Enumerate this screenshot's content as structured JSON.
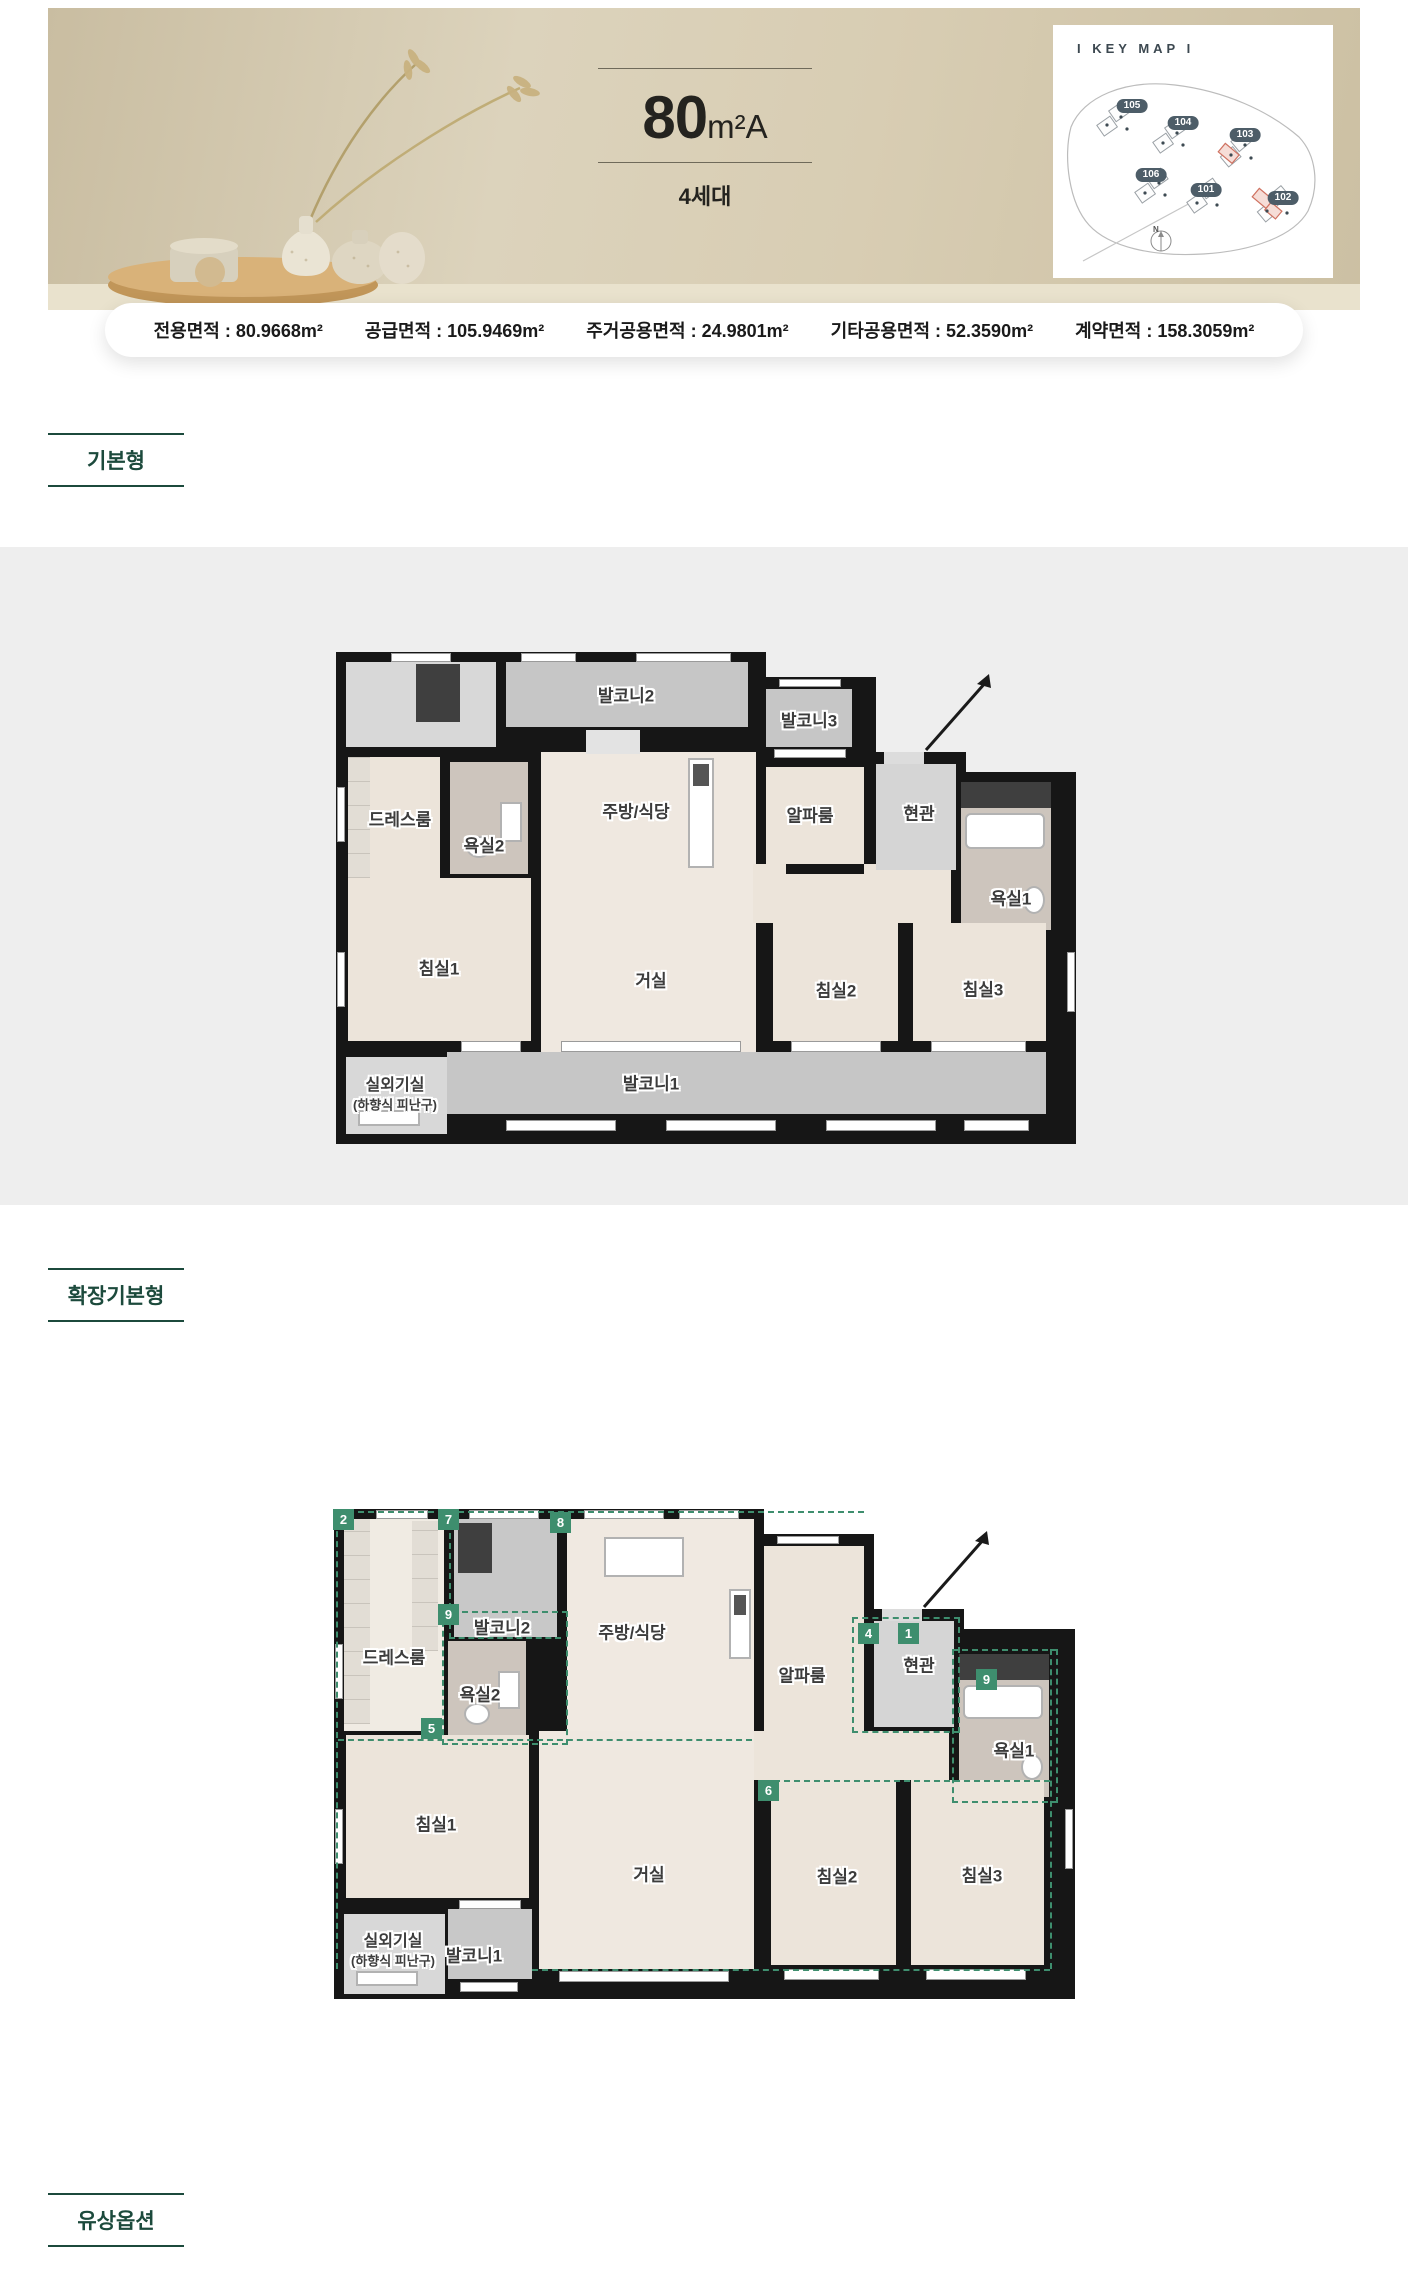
{
  "header": {
    "title_number": "80",
    "title_unit": "m²A",
    "subtitle": "4세대",
    "keymap": {
      "title": "I KEY MAP I",
      "compass": "N",
      "buildings": [
        "105",
        "104",
        "103",
        "106",
        "101",
        "102"
      ]
    },
    "area_items": [
      "전용면적 : 80.9668m²",
      "공급면적 : 105.9469m²",
      "주거공용면적 : 24.9801m²",
      "기타공용면적 : 52.3590m²",
      "계약면적 : 158.3059m²"
    ]
  },
  "sections": {
    "basic": "기본형",
    "extended": "확장기본형",
    "paid_option": "유상옵션"
  },
  "rooms": {
    "balcony2": "발코니2",
    "balcony3": "발코니3",
    "dressroom": "드레스룸",
    "bath2": "욕실2",
    "kitchen": "주방/식당",
    "alpha": "알파룸",
    "entry": "현관",
    "bath1": "욕실1",
    "bed1": "침실1",
    "living": "거실",
    "bed2": "침실2",
    "bed3": "침실3",
    "balcony1": "발코니1",
    "outdoor_unit": "실외기실",
    "outdoor_unit_sub": "(하향식 피난구)"
  },
  "extended_badges": [
    "2",
    "7",
    "8",
    "9",
    "5",
    "4",
    "1",
    "9",
    "6"
  ],
  "colors": {
    "accent_green": "#1c4a3c",
    "badge_green": "#3e8e6e",
    "wall": "#161616",
    "room_beige": "#ece4da",
    "balcony_gray": "#c6c6c6",
    "keymap_pill": "#4d5d68"
  }
}
